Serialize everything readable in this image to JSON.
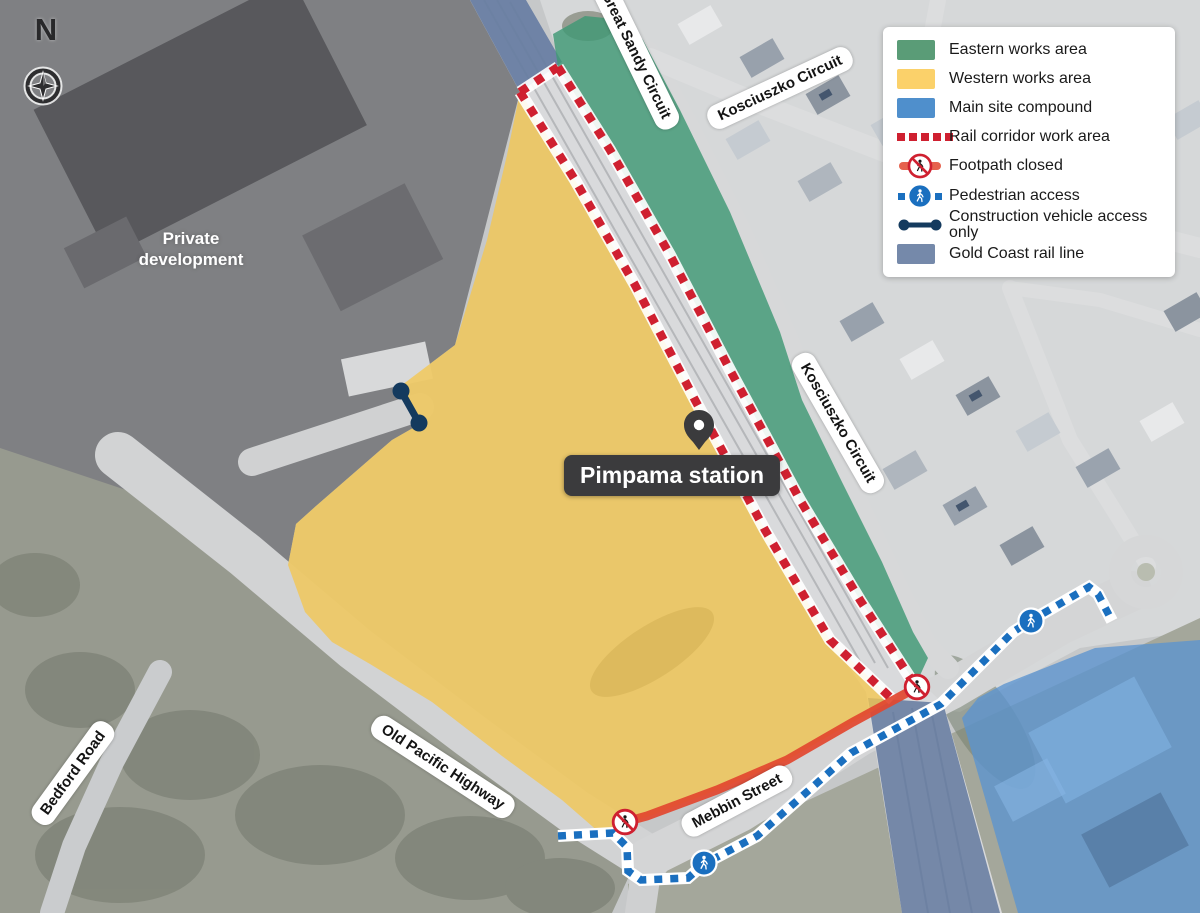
{
  "map": {
    "station_label": "Pimpama station",
    "area_label": {
      "line1": "Private",
      "line2": "development"
    },
    "compass_label": "N",
    "roads": [
      {
        "label": "Great Sandy Circuit"
      },
      {
        "label": "Kosciuszko Circuit"
      },
      {
        "label": "Kosciuszko Circuit"
      },
      {
        "label": "Old Pacific Highway"
      },
      {
        "label": "Mebbin Street"
      },
      {
        "label": "Bedford Road"
      }
    ]
  },
  "legend": {
    "items": [
      {
        "label": "Eastern works area",
        "icon": "green-swatch",
        "color": "#5a9c77"
      },
      {
        "label": "Western works area",
        "icon": "yellow-swatch",
        "color": "#fbd16a"
      },
      {
        "label": "Main site compound",
        "icon": "blue-swatch",
        "color": "#4f8fcc"
      },
      {
        "label": "Rail corridor work area",
        "icon": "red-dashed-line",
        "color": "#cf2030"
      },
      {
        "label": "Footpath closed",
        "icon": "footpath-closed-icon",
        "color": "#e2462f"
      },
      {
        "label": "Pedestrian access",
        "icon": "pedestrian-access-icon",
        "color": "#1a6fbf"
      },
      {
        "label": "Construction vehicle access only",
        "icon": "construction-access-line",
        "color": "#143a5e"
      },
      {
        "label": "Gold Coast rail line",
        "icon": "steel-swatch",
        "color": "#7589aa"
      }
    ]
  },
  "colors": {
    "eastern_works": "#3f9975",
    "western_works": "#f3c74f",
    "main_site_compound": "#5b94cf",
    "rail_corridor_red": "#cf2030",
    "footpath_closed_red": "#e2462f",
    "pedestrian_blue": "#1a6fbf",
    "construction_navy": "#143a5e",
    "rail_line_steel": "#667ca1"
  }
}
